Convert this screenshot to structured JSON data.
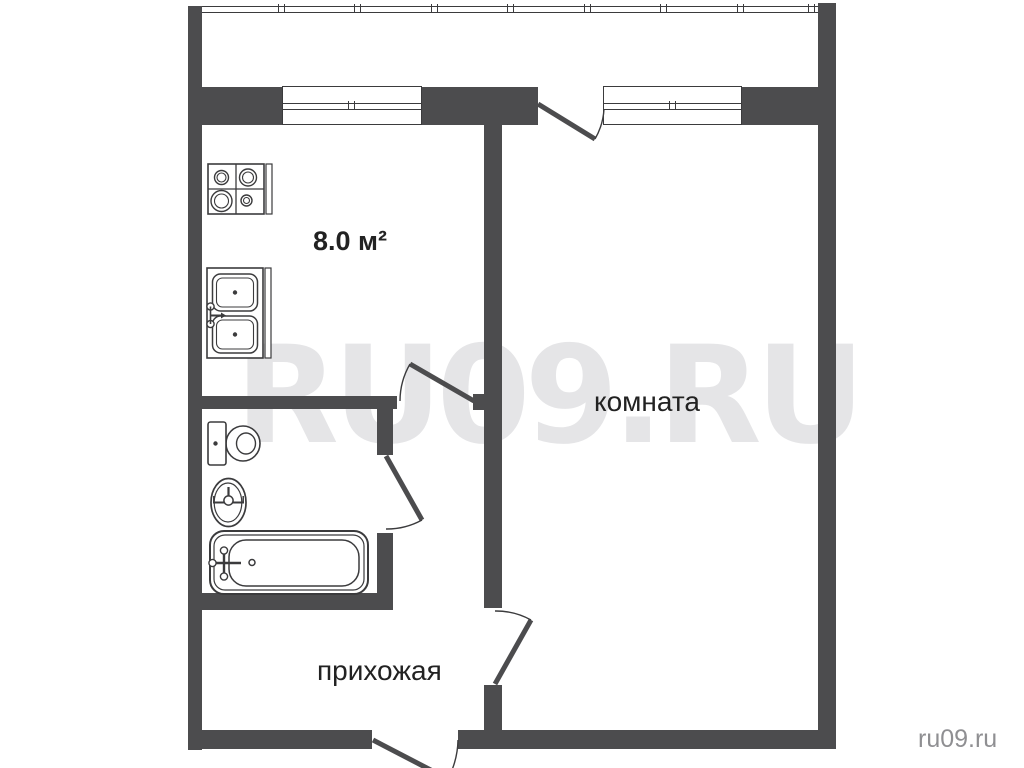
{
  "colors": {
    "wall": "#4c4c4e",
    "line": "#3b3b3d",
    "label": "#222222",
    "watermark": "#e5e5e7",
    "site": "#8f8f92",
    "bg": "#ffffff"
  },
  "watermark": {
    "center": "RU09.RU",
    "corner": "ru09.ru"
  },
  "labels": {
    "kitchen_area": "8.0 м²",
    "room": "комната",
    "hallway": "прихожая"
  },
  "fixtures": [
    "stove-icon",
    "kitchen-sink-icon",
    "toilet-icon",
    "washbasin-icon",
    "bathtub-icon"
  ],
  "plan": {
    "type": "apartment-floor-plan",
    "rooms": [
      "balcony",
      "kitchen",
      "room",
      "bathroom",
      "hallway"
    ]
  }
}
